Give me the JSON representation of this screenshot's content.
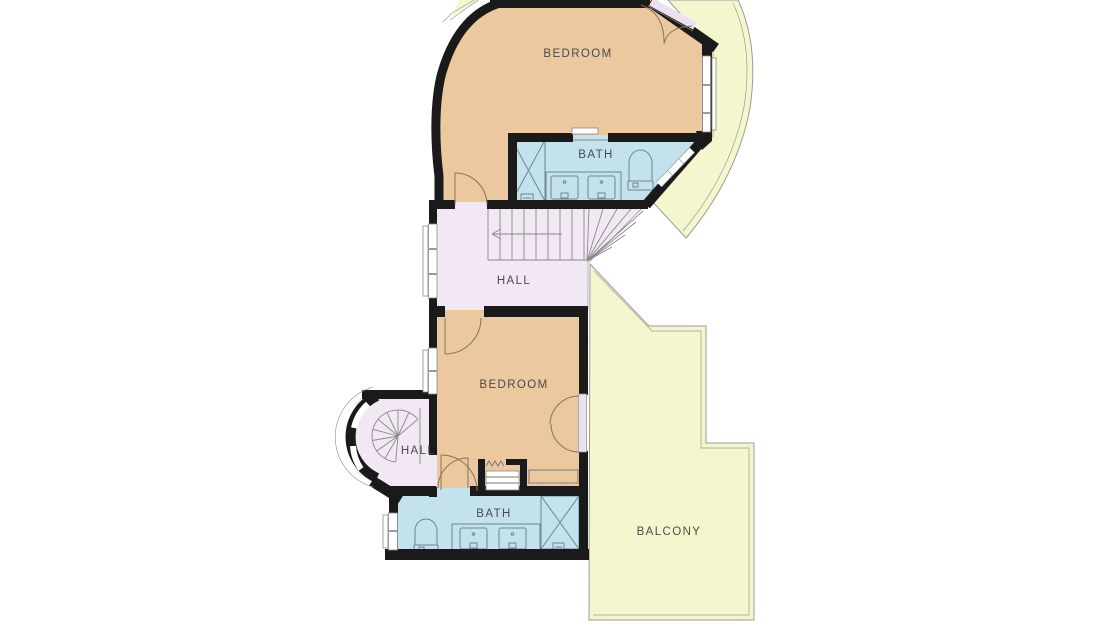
{
  "floorplan": {
    "rooms": [
      {
        "id": "bedroom-upper",
        "label": "BEDROOM"
      },
      {
        "id": "bath-upper",
        "label": "BATH"
      },
      {
        "id": "hall-upper",
        "label": "HALL"
      },
      {
        "id": "bedroom-lower",
        "label": "BEDROOM"
      },
      {
        "id": "hall-lower",
        "label": "HALL"
      },
      {
        "id": "bath-lower",
        "label": "BATH"
      },
      {
        "id": "balcony",
        "label": "BALCONY"
      }
    ],
    "fixtures": [
      "shower",
      "double-vanity",
      "toilet",
      "closet",
      "straight-staircase",
      "spiral-staircase",
      "french-doors",
      "windows"
    ],
    "colors": {
      "bedroom": "#ebc89d",
      "bath": "#c4e2ec",
      "hall": "#f2e8f4",
      "balcony": "#f4f6cd",
      "wall": "#1a1a1a",
      "window": "#ffffff",
      "line": "#8a8a8a",
      "outline": "#9c9c9c",
      "door_arc": "#8a7258",
      "door_panel": "#ebe1f0",
      "label": "#4b4b4b",
      "background": "#ffffff"
    }
  }
}
